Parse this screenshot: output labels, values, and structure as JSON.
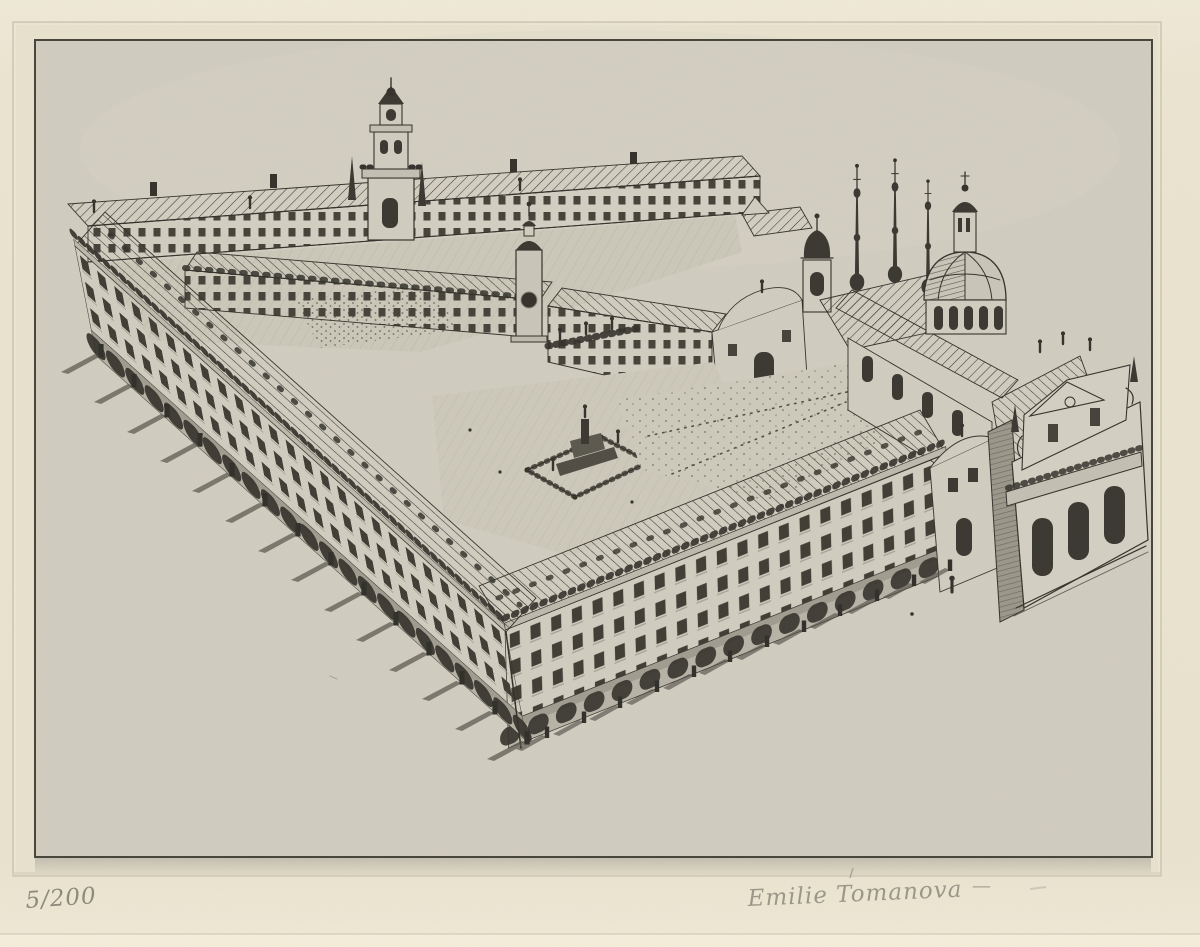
{
  "inscriptions": {
    "edition": "5/200",
    "signature": "Emilie Tomanova",
    "flourish": "—"
  },
  "colors": {
    "mat": "#ebe4d0",
    "mat_lower": "#f4edda",
    "paper": "#d0ccbf",
    "ink": "#34322b",
    "pencil": "#8f897c"
  }
}
